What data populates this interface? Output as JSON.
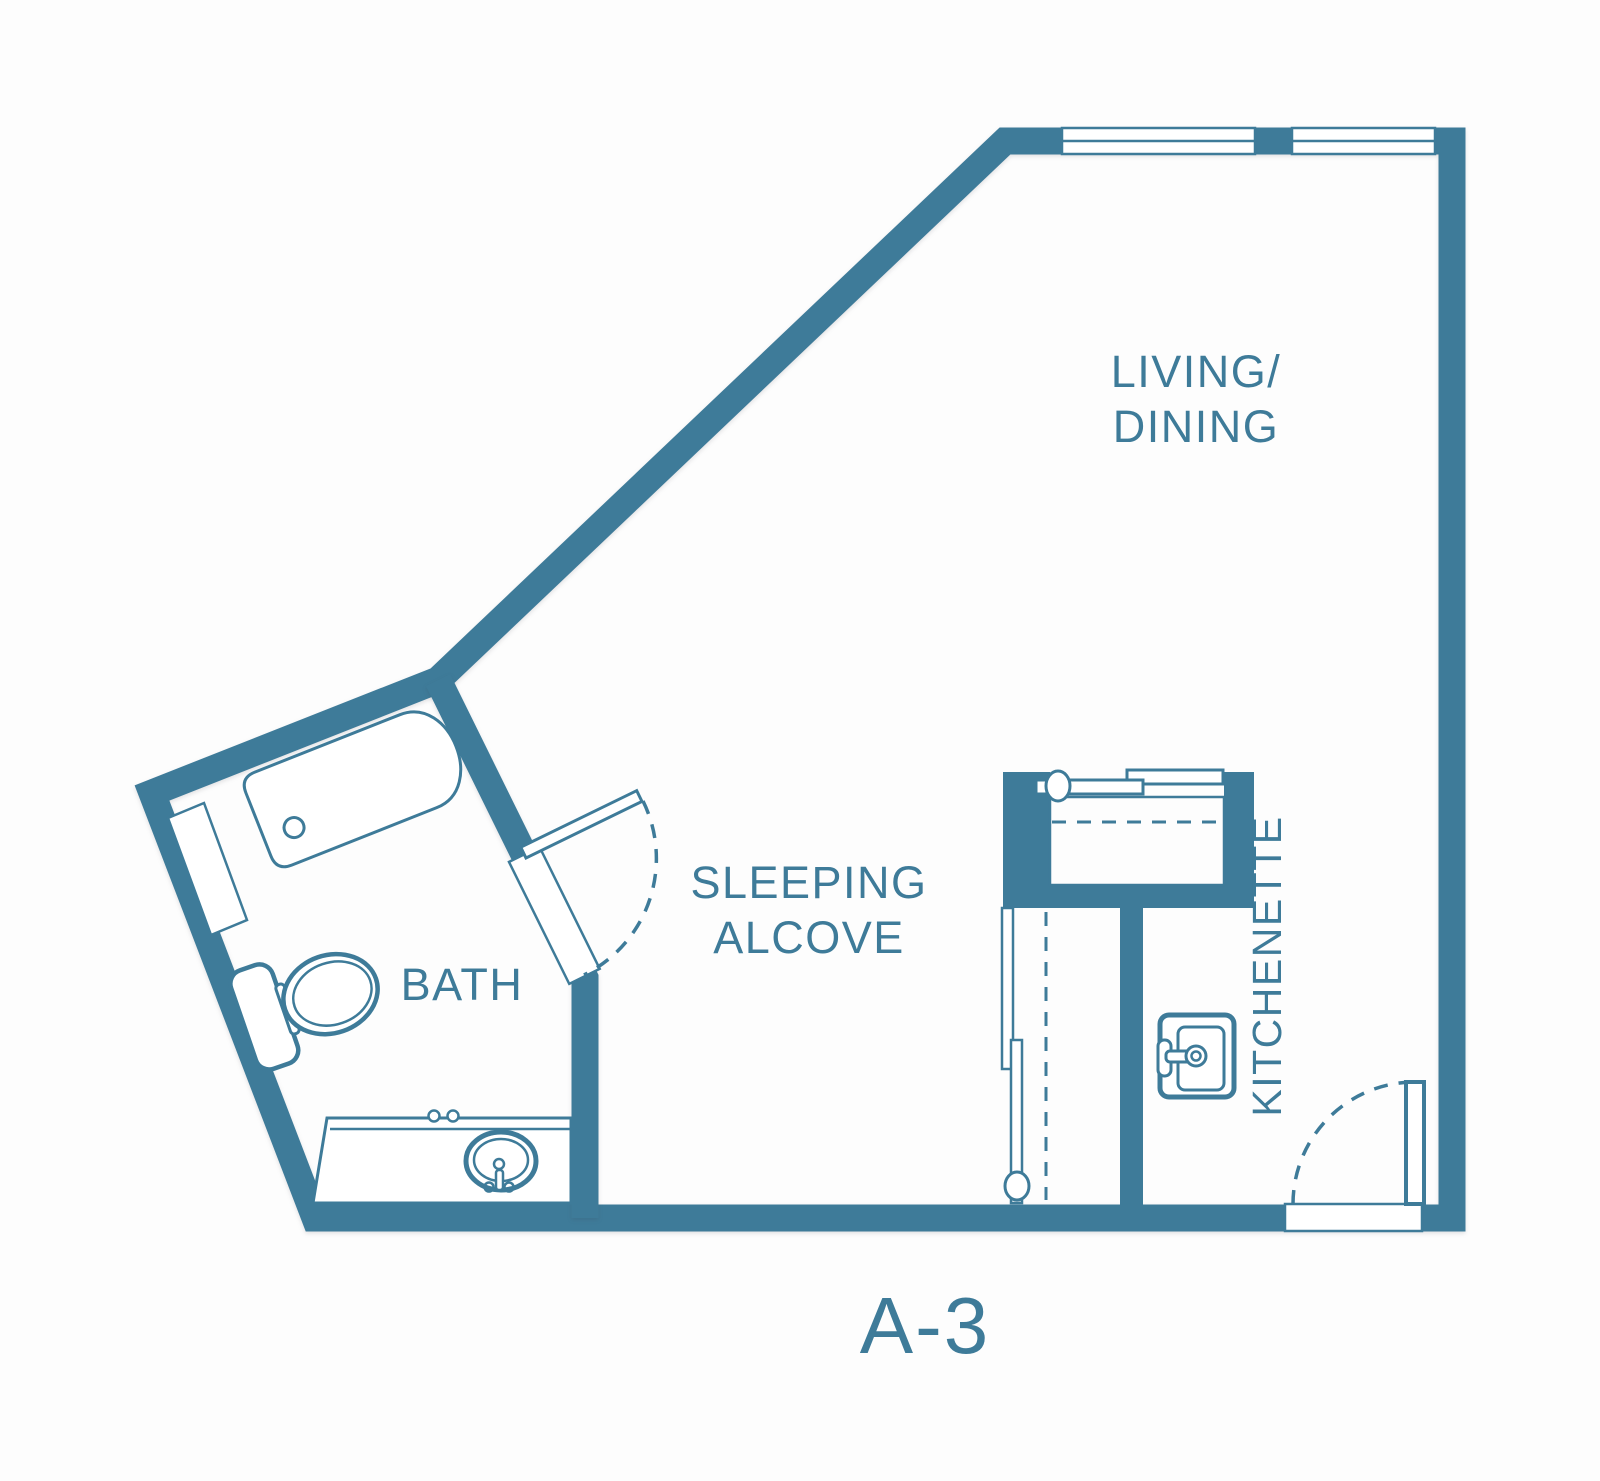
{
  "plan": {
    "unit_label": "A-3",
    "rooms": {
      "living_dining": {
        "line1": "LIVING/",
        "line2": "DINING"
      },
      "sleeping_alcove": {
        "line1": "SLEEPING",
        "line2": "ALCOVE"
      },
      "bath": {
        "label": "BATH"
      },
      "kitchenette": {
        "label": "KITCHENETTE"
      }
    },
    "fixtures": {
      "bathtub": "bathtub",
      "toilet": "toilet",
      "vanity_sink": "vanity with sink",
      "kitchen_sink": "kitchen sink",
      "closet_upper": "storage closet with bypass sliding doors",
      "closet_lower": "closet with sliding doors",
      "bath_door": "swing door with arc",
      "entry_door": "entry swing door with arc",
      "windows": "two windows in top wall"
    },
    "colors": {
      "wall": "#3E7B99",
      "text": "#3E7B99",
      "background": "#FDFDFD"
    }
  }
}
